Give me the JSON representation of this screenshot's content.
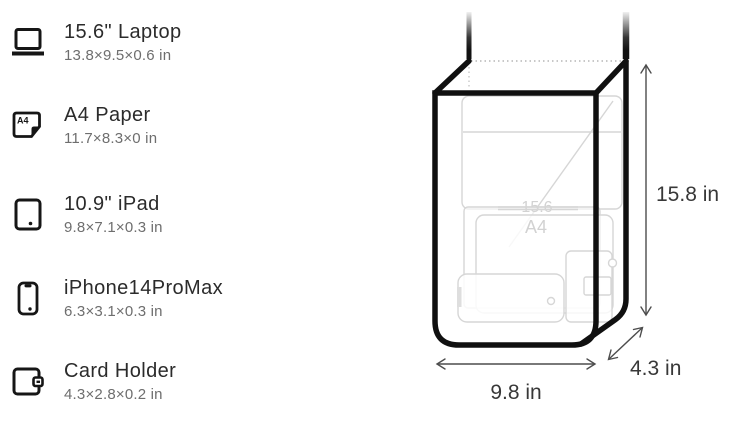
{
  "capacity_list": {
    "items": [
      {
        "icon": "laptop-icon",
        "name": "15.6\" Laptop",
        "dimensions": "13.8×9.5×0.6 in"
      },
      {
        "icon": "a4-paper-icon",
        "name": "A4 Paper",
        "dimensions": "11.7×8.3×0 in",
        "icon_label": "A4"
      },
      {
        "icon": "ipad-icon",
        "name": "10.9\" iPad",
        "dimensions": "9.8×7.1×0.3 in"
      },
      {
        "icon": "iphone-icon",
        "name": "iPhone14ProMax",
        "dimensions": "6.3×3.1×0.3 in"
      },
      {
        "icon": "card-holder-icon",
        "name": "Card Holder",
        "dimensions": "4.3×2.8×0.2 in"
      }
    ]
  },
  "bag_diagram": {
    "height_label": "15.8 in",
    "width_label": "9.8 in",
    "depth_label": "4.3 in",
    "watermark_laptop": "15.6",
    "watermark_a4": "A4"
  },
  "colors": {
    "ink": "#111111",
    "title_text": "#2b2b2b",
    "subtitle_text": "#6e6e6e",
    "ghost_line": "#d6d6d6",
    "watermark_text": "#d2d2d2",
    "dimension_text": "#383838"
  }
}
